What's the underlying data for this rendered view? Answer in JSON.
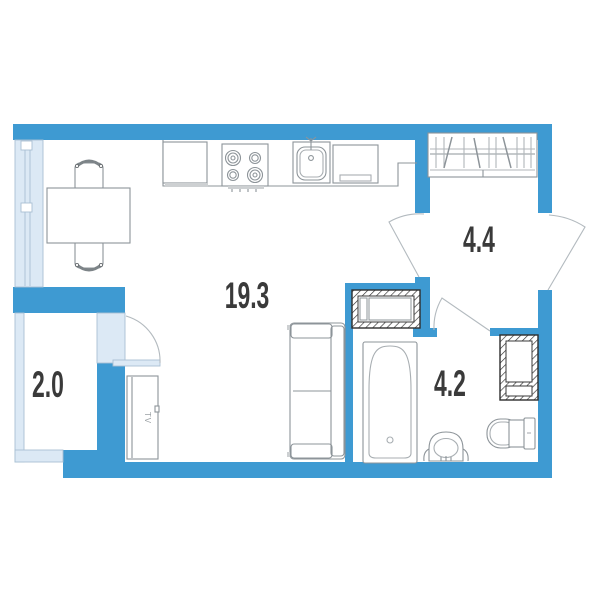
{
  "floorplan": {
    "rooms": [
      {
        "id": "living-room-kitchen",
        "area_label": "19.3"
      },
      {
        "id": "hallway",
        "area_label": "4.4"
      },
      {
        "id": "balcony",
        "area_label": "2.0"
      },
      {
        "id": "bathroom",
        "area_label": "4.2"
      }
    ],
    "furniture": {
      "tv_label": "TV"
    },
    "colors": {
      "wall": "#3e9ad2",
      "glazing": "#dce9f5",
      "glazing_stroke": "#a9bfd3",
      "outline": "#8d9499",
      "door_arc": "#b3babf",
      "label": "#3a3a3a"
    }
  }
}
